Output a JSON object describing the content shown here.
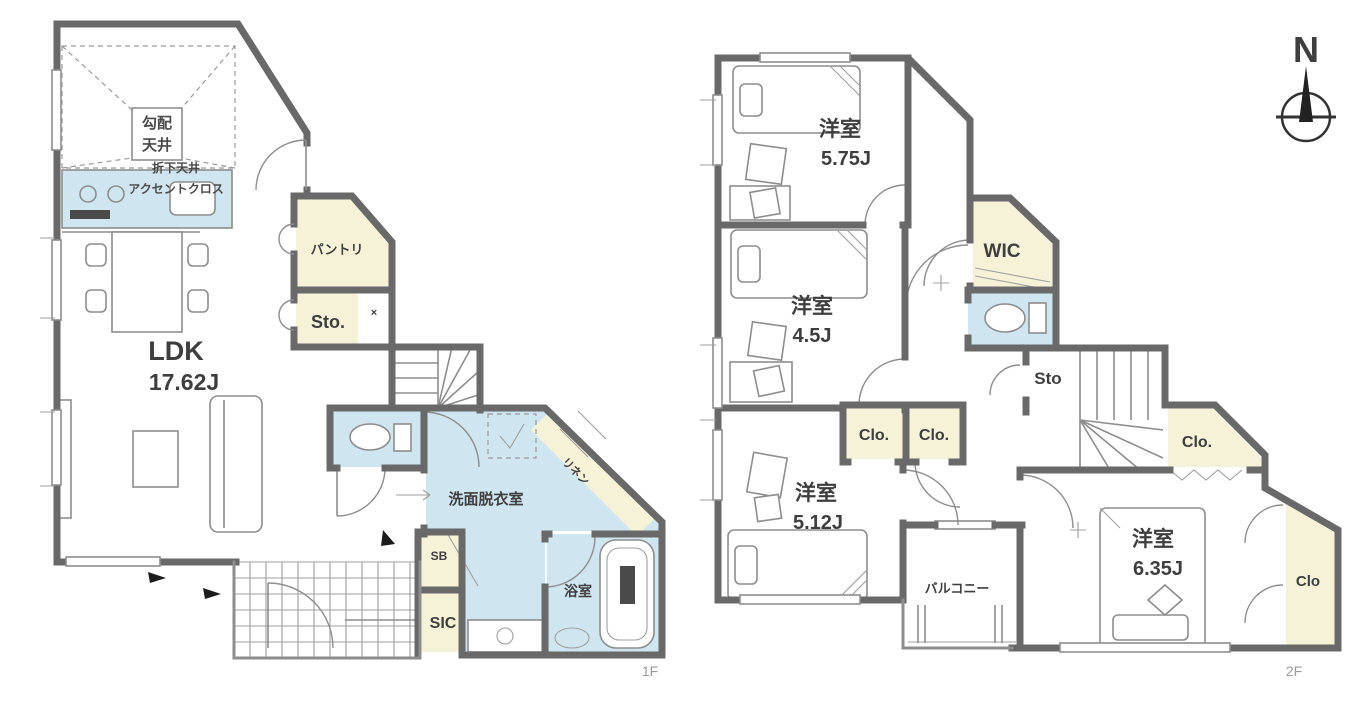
{
  "palette": {
    "wall": "#696969",
    "water_blue": "#cfe5f0",
    "storage_cream": "#f6f2d8",
    "outline_gray": "#8d8d8d",
    "text_dark": "#3e3e3e",
    "text_muted": "#9a9a9a"
  },
  "compass": {
    "north": "N"
  },
  "f1": {
    "label": "1F",
    "ldk": "LDK",
    "ldk_size": "17.62J",
    "callout_l1": "勾配",
    "callout_l2": "天井",
    "note1": "折下天井",
    "note2": "アクセントクロス",
    "pantry": "パントリ",
    "sto": "Sto.",
    "sto_x": "×",
    "washroom": "洗面脱衣室",
    "linen": "リネン",
    "bath": "浴室",
    "sb": "SB",
    "sic": "SIC"
  },
  "f2": {
    "label": "2F",
    "b1": "洋室",
    "b1_size": "5.75J",
    "b2": "洋室",
    "b2_size": "4.5J",
    "b3": "洋室",
    "b3_size": "5.12J",
    "b4": "洋室",
    "b4_size": "6.35J",
    "wic": "WIC",
    "sto": "Sto",
    "clo1": "Clo.",
    "clo2": "Clo.",
    "clo3": "Clo.",
    "clo4": "Clo",
    "balcony": "バルコニー"
  }
}
